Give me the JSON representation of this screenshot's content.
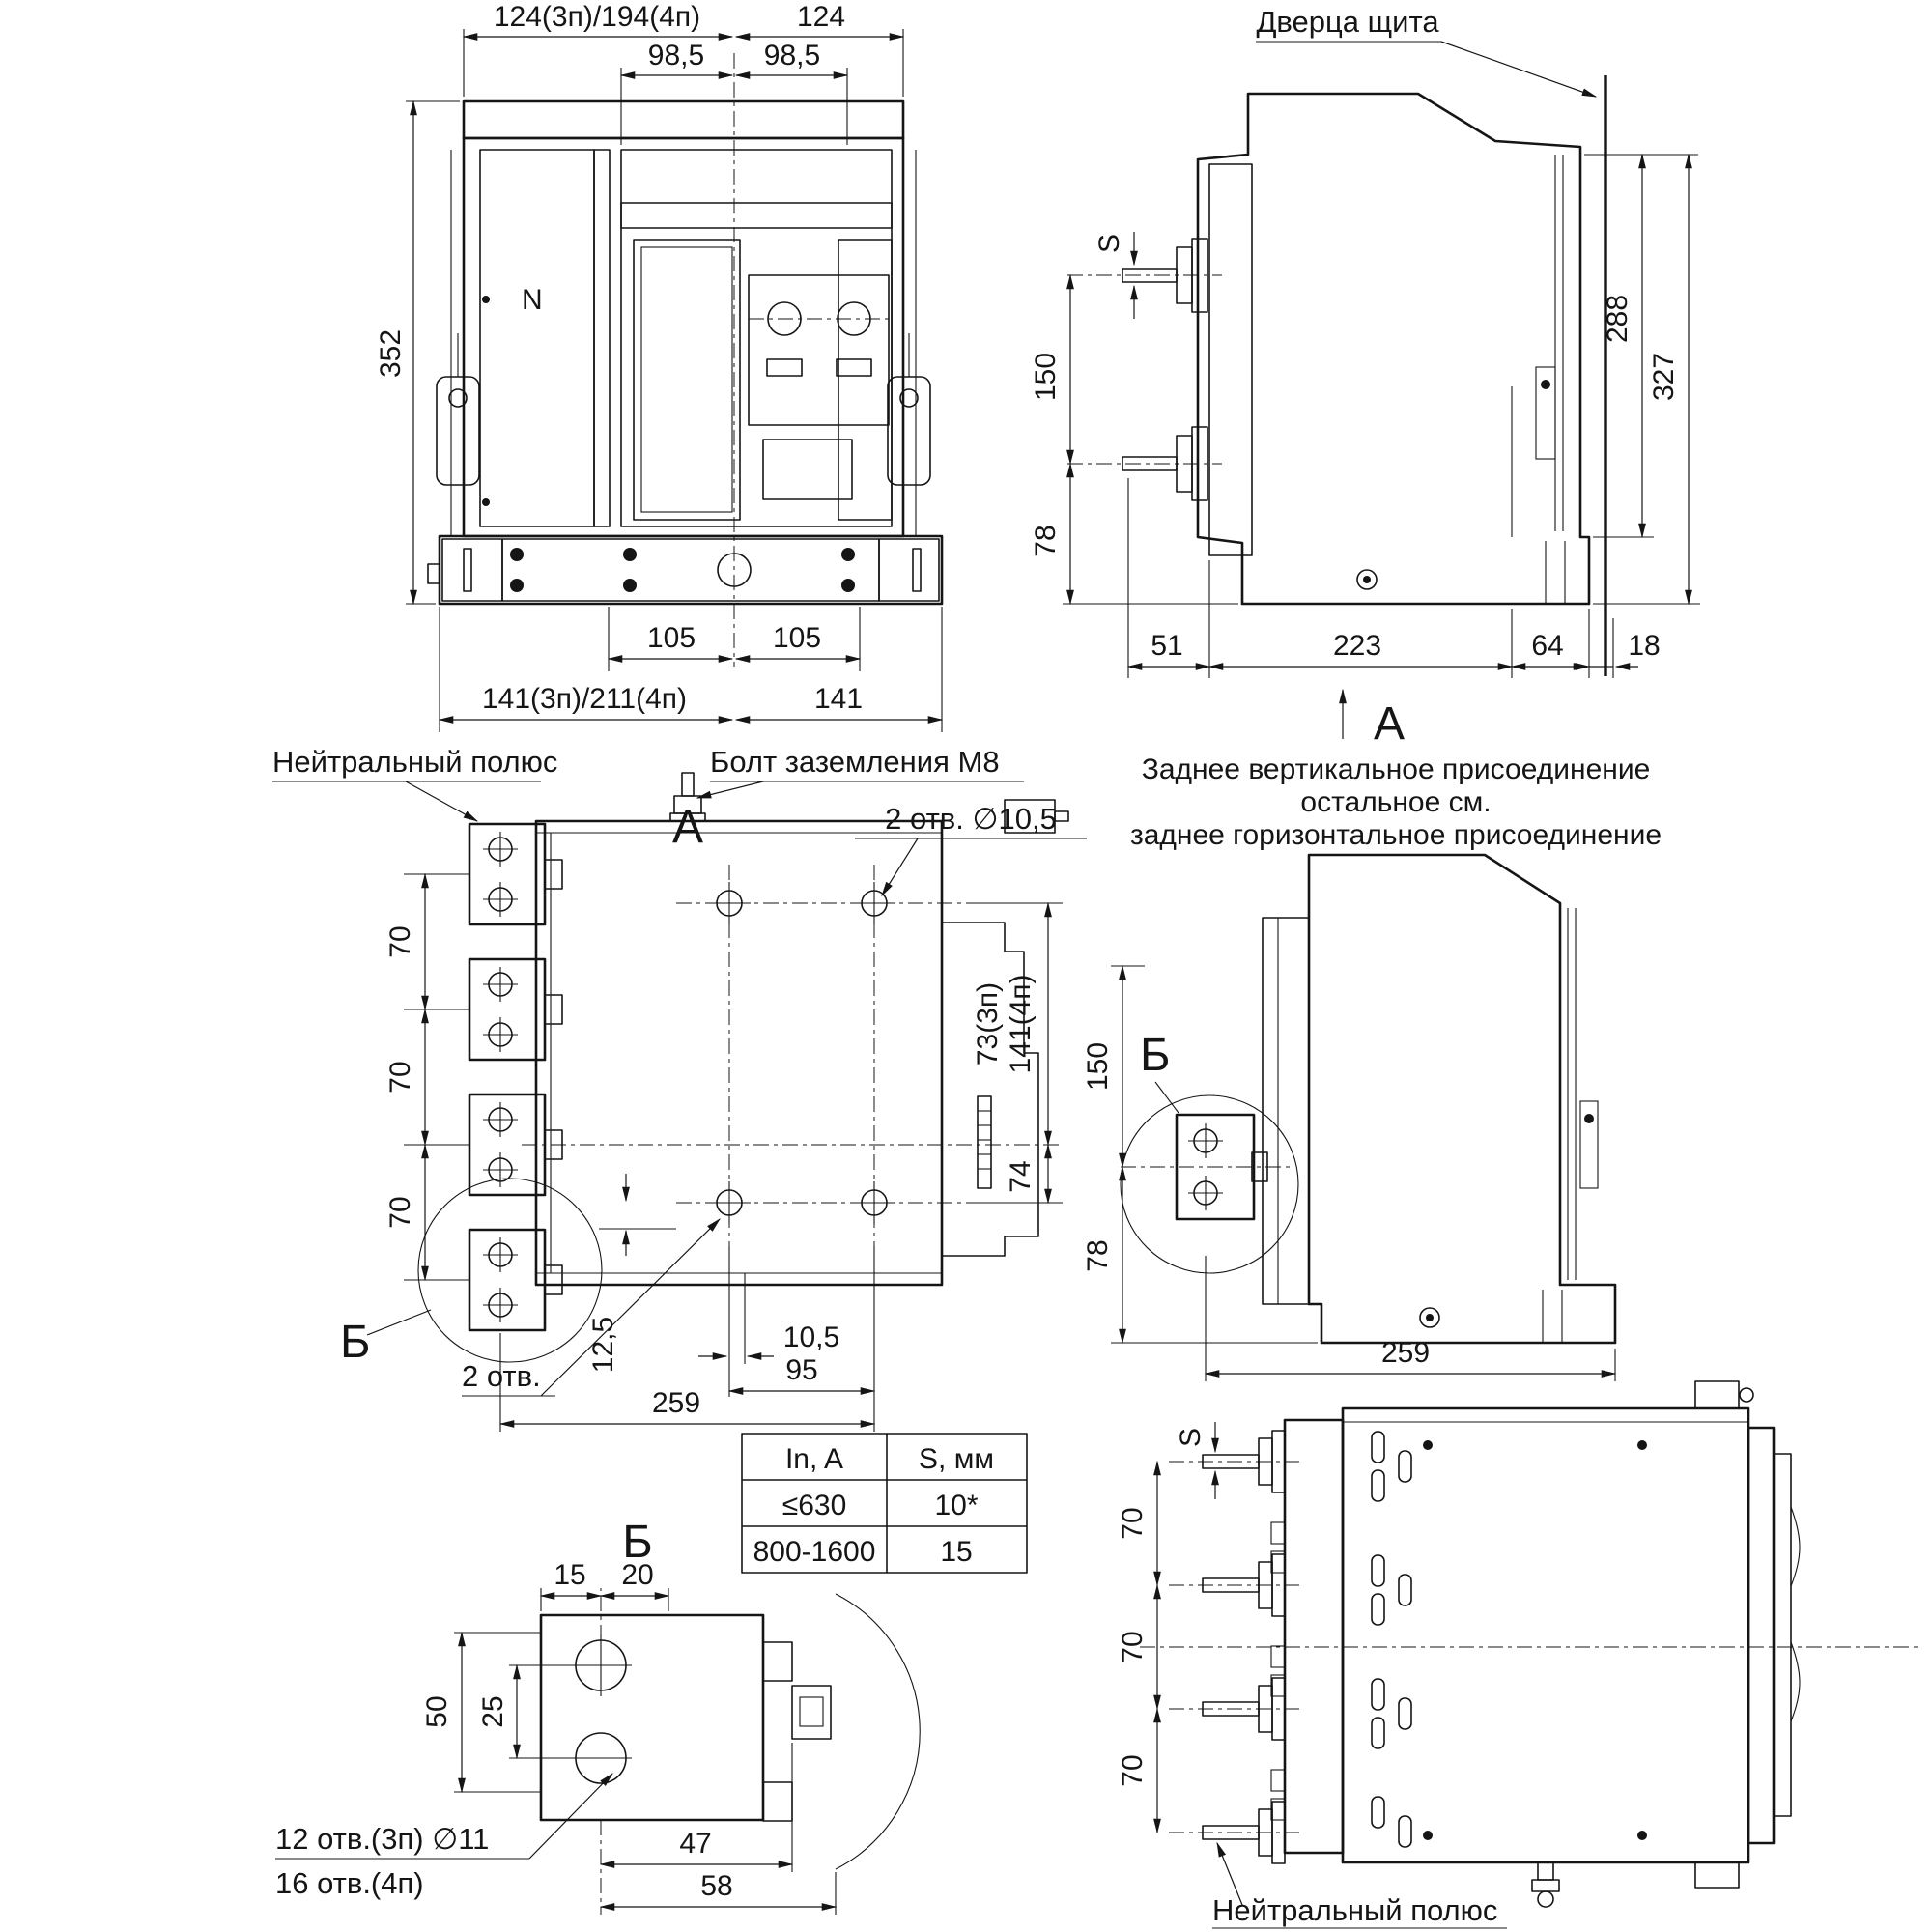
{
  "front": {
    "view_label": "А",
    "pole_n": "N",
    "dim_top_left": "124(3п)/194(4п)",
    "dim_top_right": "124",
    "dim_98_left": "98,5",
    "dim_98_right": "98,5",
    "dim_height": "352",
    "dim_105_left": "105",
    "dim_105_right": "105",
    "dim_bot_left": "141(3п)/211(4п)",
    "dim_bot_right": "141"
  },
  "side_top": {
    "door_label": "Дверца щита",
    "dim_s": "S",
    "dim_150": "150",
    "dim_78": "78",
    "dim_288": "288",
    "dim_327": "327",
    "dim_51": "51",
    "dim_223": "223",
    "dim_64": "64",
    "dim_18": "18",
    "view_label": "А",
    "caption1": "Заднее вертикальное присоединение",
    "caption2": "остальное см.",
    "caption3": "заднее горизонтальное присоединение"
  },
  "rear": {
    "label_neutral": "Нейтральный полюс",
    "label_bolt": "Болт заземления М8",
    "label_holes_top": "2 отв. ∅10,5",
    "pitch": [
      "70",
      "70",
      "70"
    ],
    "dim_73": "73(3п)",
    "dim_141": "141(4п)",
    "dim_74": "74",
    "dim_12_5": "12,5",
    "dim_10_5": "10,5",
    "dim_95": "95",
    "dim_259": "259",
    "label_holes_bot": "2 отв.",
    "detail": "Б"
  },
  "side_mid": {
    "dim_150": "150",
    "dim_78": "78",
    "dim_259": "259",
    "detail": "Б"
  },
  "table": {
    "h1": "In, A",
    "h2": "S, мм",
    "r1c1": "≤630",
    "r1c2": "10*",
    "r2c1": "800-1600",
    "r2c2": "15"
  },
  "detail_b": {
    "title": "Б",
    "dim_15": "15",
    "dim_20": "20",
    "dim_50": "50",
    "dim_25": "25",
    "dim_47": "47",
    "dim_58": "58",
    "label_holes1": "12 отв.(3п) ∅11",
    "label_holes2": "16 отв.(4п)"
  },
  "top_view": {
    "dim_s": "S",
    "pitch": [
      "70",
      "70",
      "70"
    ],
    "label_neutral": "Нейтральный полюс"
  }
}
